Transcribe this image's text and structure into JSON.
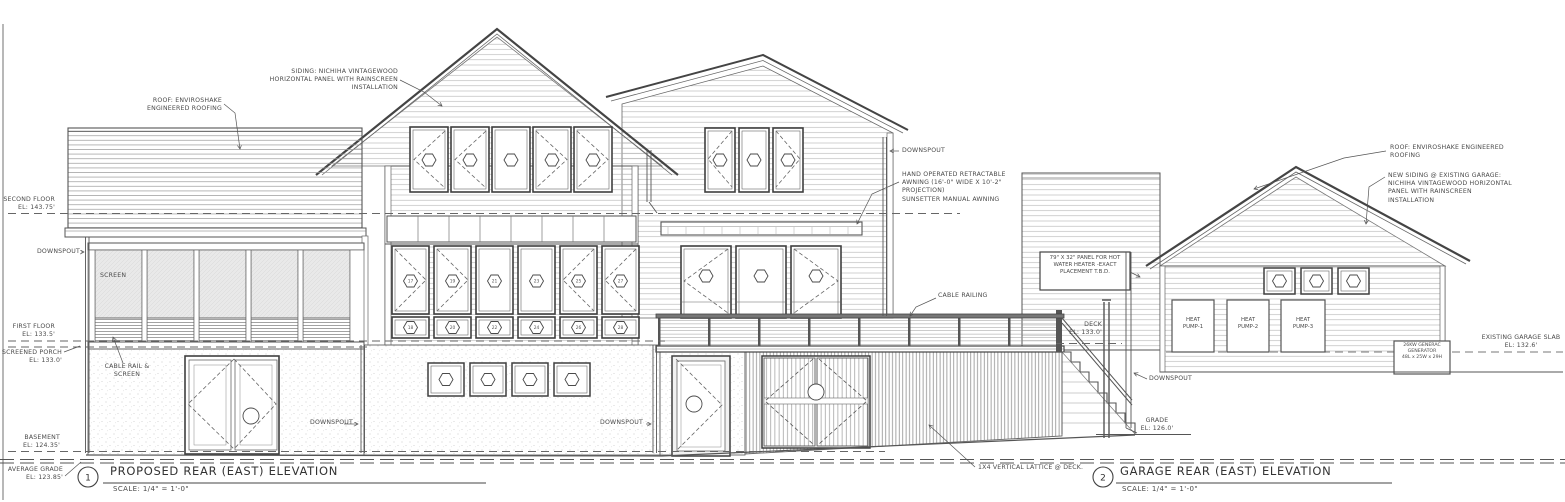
{
  "sheet": {
    "titles": [
      {
        "number": "1",
        "title": "PROPOSED REAR (EAST) ELEVATION",
        "scale": "SCALE: 1/4\" = 1'-0\""
      },
      {
        "number": "2",
        "title": "GARAGE REAR (EAST) ELEVATION",
        "scale": "SCALE: 1/4\" = 1'-0\""
      }
    ],
    "elevation_markers": {
      "second_floor": "SECOND FLOOR\nEL: 143.75'",
      "first_floor": "FIRST FLOOR\nEL: 133.5'",
      "screened_porch": "SCREENED PORCH\nEL: 133.0'",
      "basement": "BASEMENT\nEL: 124.35'",
      "average_grade": "AVERAGE GRADE\nEL: 123.85'",
      "deck": "DECK\nEL: 133.0'",
      "grade": "GRADE\nEL: 126.0'",
      "existing_garage_slab": "EXISTING GARAGE SLAB\nEL: 132.6'"
    },
    "annotations": {
      "roof_main": "ROOF: ENVIROSHAKE\nENGINEERED ROOFING",
      "siding_main": "SIDING: NICHIHA VINTAGEWOOD\nHORIZONTAL PANEL WITH RAINSCREEN\nINSTALLATION",
      "downspout": "DOWNSPOUT",
      "awning": "HAND OPERATED RETRACTABLE\nAWNING (16'-0\" WIDE X 10'-2\"\nPROJECTION)\nSUNSETTER MANUAL AWNING",
      "screen": "SCREEN",
      "cable_rail_screen": "CABLE RAIL &\nSCREEN",
      "cable_railing": "CABLE RAILING",
      "lattice": "1X4 VERTICAL LATTICE @ DECK.",
      "water_heater_panel": "79\" X 32\" PANEL FOR HOT\nWATER HEATER -EXACT\nPLACEMENT T.B.D.",
      "heat_pump_1": "HEAT\nPUMP-1",
      "heat_pump_2": "HEAT\nPUMP-2",
      "heat_pump_3": "HEAT\nPUMP-3",
      "generator": "26KW GENERAC\nGENERATOR\n48L x 25W x 29H",
      "roof_garage": "ROOF: ENVIROSHAKE ENGINEERED\nROOFING",
      "siding_garage": "NEW SIDING @ EXISTING GARAGE:\nNICHIHA VINTAGEWOOD HORIZONTAL\nPANEL WITH RAINSCREEN\nINSTALLATION"
    },
    "window_tags": {
      "first_floor_upper": [
        "17",
        "19",
        "21",
        "23",
        "25",
        "27"
      ],
      "first_floor_lower": [
        "18",
        "20",
        "22",
        "24",
        "26",
        "28"
      ]
    }
  }
}
